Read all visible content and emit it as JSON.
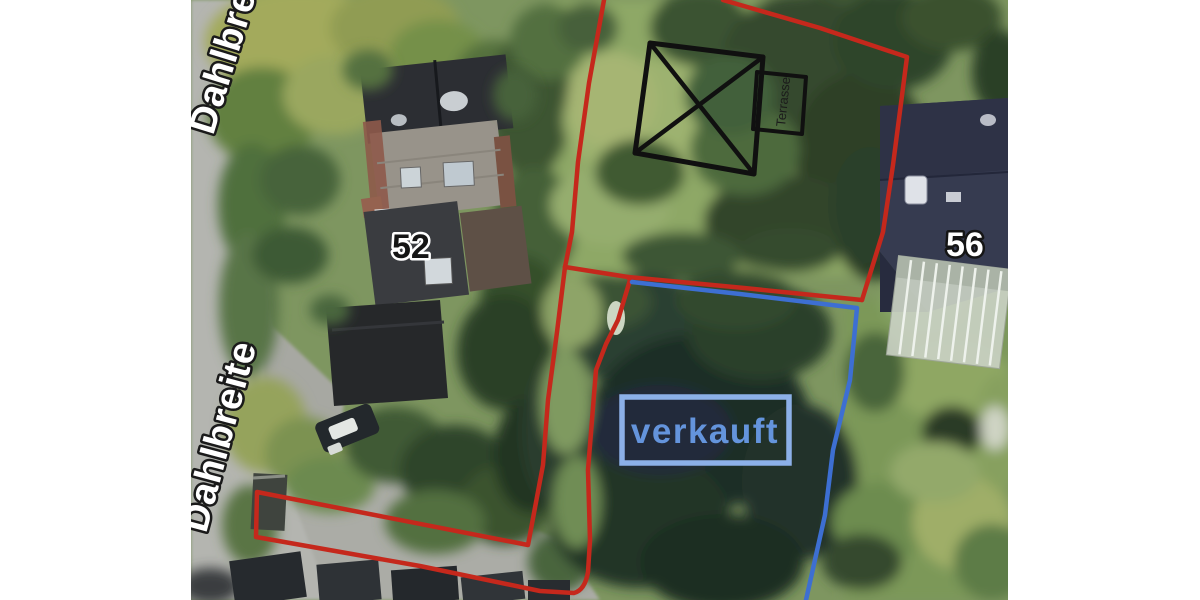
{
  "map": {
    "street_top": {
      "label": "Dahlbreite"
    },
    "street_left": {
      "label": "Dahlbreite"
    },
    "houses": {
      "left_number": "52",
      "right_number": "56"
    },
    "annotations": {
      "sold_label": "verkauft",
      "terrace_label": "Terrasse",
      "boundary_red_color": "#c5281c",
      "boundary_blue_color": "#3d6fd2",
      "sold_box_border_color": "#8cb0e8",
      "sold_text_color": "#6494dc",
      "building_outline_color": "#101010"
    }
  }
}
